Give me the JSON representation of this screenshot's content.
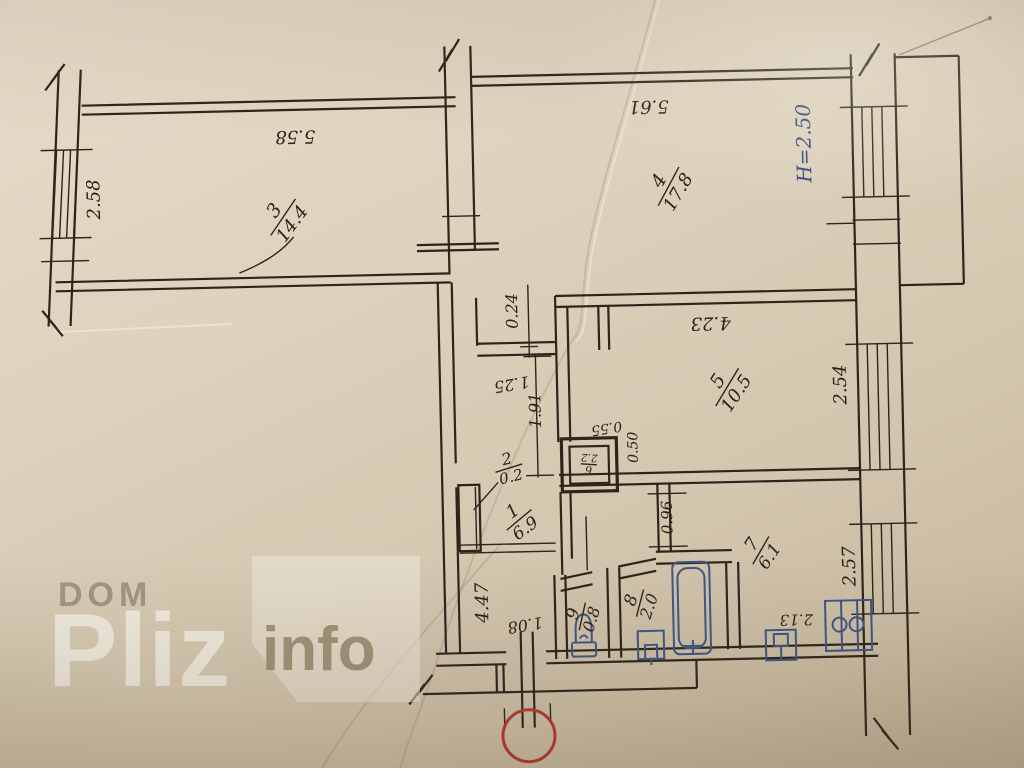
{
  "photo": {
    "paper_color": "#d9cdb7",
    "ink_color": "#2d241c",
    "blue_ink_color": "#3d5685",
    "red_circle_color": "#b5362e"
  },
  "watermark": {
    "word1": "DOM",
    "word2": "Pliz",
    "word3": "info"
  },
  "plan": {
    "ceiling_height": "H=2.50",
    "rooms": {
      "r1": {
        "num": "1",
        "area": "6.9"
      },
      "r2": {
        "num": "2",
        "area": "0.2"
      },
      "r3": {
        "num": "3",
        "area": "14.4"
      },
      "r4": {
        "num": "4",
        "area": "17.8"
      },
      "r5": {
        "num": "5",
        "area": "10.5"
      },
      "r6": {
        "num": "6",
        "area": "2.2"
      },
      "r7": {
        "num": "7",
        "area": "6.1"
      },
      "r8": {
        "num": "8",
        "area": "2.0"
      },
      "r9": {
        "num": "9",
        "area": "0.8"
      }
    },
    "dims": {
      "room3_width": "5.58",
      "room3_window": "2.58",
      "room4_width": "5.61",
      "wall_thickness": "0.24",
      "room5_width": "4.23",
      "closet_width": "1.25",
      "closet_depth": "1.91",
      "shaft_width": "0.55",
      "shaft_depth": "0.50",
      "room5_window": "2.54",
      "kitchen_opening": "0.96",
      "kitchen_window": "2.57",
      "kitchen_dim": "2.13",
      "hall_length": "4.47",
      "entry_width": "1.08"
    }
  }
}
